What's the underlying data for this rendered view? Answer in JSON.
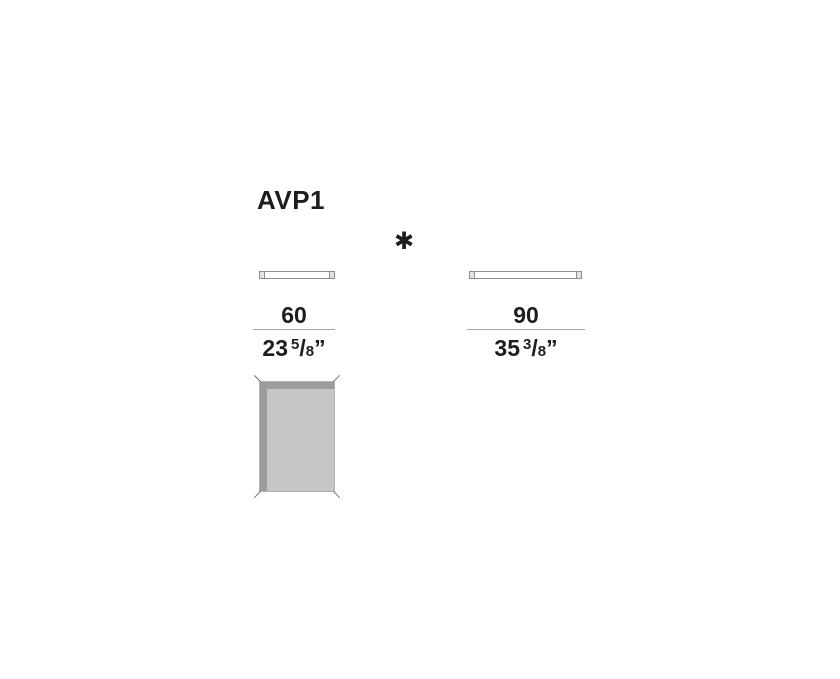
{
  "colors": {
    "text": "#1d1d1b",
    "rule": "#a6a6a6",
    "bar_border": "#8d8d8d",
    "bar_cap_fill": "#e3e3e3",
    "top_view_fill": "#c6c6c6",
    "top_view_edge_band": "#9c9c9c",
    "top_view_border": "#b3b3b3"
  },
  "title": "AVP1",
  "footnote_symbol": "✱",
  "variants": [
    {
      "id": "width-60",
      "width_cm": "60",
      "inches_whole": "23",
      "fraction_numerator": "5",
      "fraction_slash": "/",
      "fraction_denominator": "8",
      "unit_mark": "”"
    },
    {
      "id": "width-90",
      "width_cm": "90",
      "inches_whole": "35",
      "fraction_numerator": "3",
      "fraction_slash": "/",
      "fraction_denominator": "8",
      "unit_mark": "”"
    }
  ]
}
